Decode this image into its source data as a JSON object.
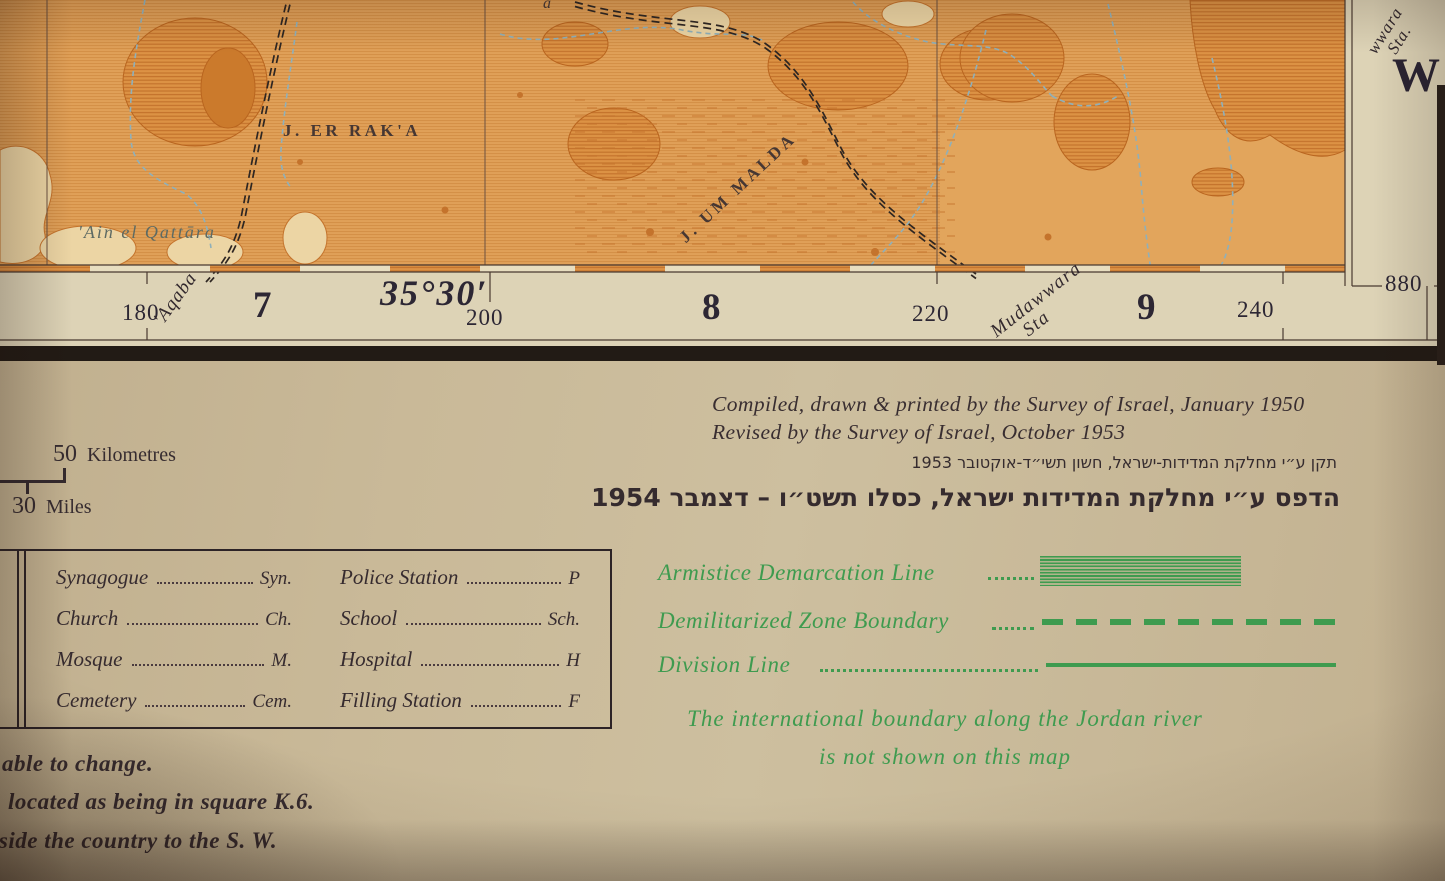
{
  "photo": {
    "colors": {
      "map_orange": "#de9a50",
      "hatch_orange": "#c4732c",
      "paper_tan": "#c7b594",
      "margin_cream": "#ddd3b6",
      "ink_dark": "#362b30",
      "boundary_green": "#3e9b4f",
      "wadi_blue": "#8fb0ba"
    }
  },
  "map": {
    "place_labels": {
      "jebel_er_raka": "J. ER RAK'A",
      "jebel_um_malda": "J. UM MALDA",
      "ain_el_qattara": "'Ain el Qattāra",
      "top_edge_fragment": "a"
    },
    "margin": {
      "grid_180": "180",
      "aqaba": "'Aqaba",
      "square_7": "7",
      "longitude": "35°30′",
      "grid_200": "200",
      "square_8": "8",
      "grid_220": "220",
      "mudawwara_line1": "Mudawwara",
      "mudawwara_line2": "Sta",
      "square_9": "9",
      "grid_240": "240",
      "northing_880": "880",
      "right_label_line1": "wwara",
      "right_label_line2": "Sta.",
      "sheet_letter": "W"
    }
  },
  "credits": {
    "line1": "Compiled, drawn & printed by the Survey of Israel, January 1950",
    "line2": "Revised by the Survey of Israel, October 1953",
    "hebrew_line1": "תקן ע״י מחלקת המדידות-ישראל, חשון תשי״ד-אוקטובר 1953",
    "hebrew_line2": "הדפס ע״י מחלקת המדידות ישראל, כסלו תשט״ו – דצמבר 1954"
  },
  "scale_bar": {
    "km_value": "50",
    "km_unit": "Kilometres",
    "miles_value": "30",
    "miles_unit": "Miles"
  },
  "legend": {
    "left": [
      {
        "label": "Synagogue",
        "abbr": "Syn."
      },
      {
        "label": "Church",
        "abbr": "Ch."
      },
      {
        "label": "Mosque",
        "abbr": "M."
      },
      {
        "label": "Cemetery",
        "abbr": "Cem."
      }
    ],
    "right": [
      {
        "label": "Police Station",
        "abbr": "P"
      },
      {
        "label": "School",
        "abbr": "Sch."
      },
      {
        "label": "Hospital",
        "abbr": "H"
      },
      {
        "label": "Filling Station",
        "abbr": "F"
      }
    ]
  },
  "boundaries": {
    "armistice_label": "Armistice Demarcation Line",
    "dmz_label": "Demilitarized Zone Boundary",
    "division_label": "Division Line",
    "note_line1": "The international boundary along the Jordan river",
    "note_line2": "is not shown on this map"
  },
  "marginal_notes": {
    "note1": "able to change.",
    "note2": "located as being in square K.6.",
    "note3": "tside the country to the S. W."
  }
}
